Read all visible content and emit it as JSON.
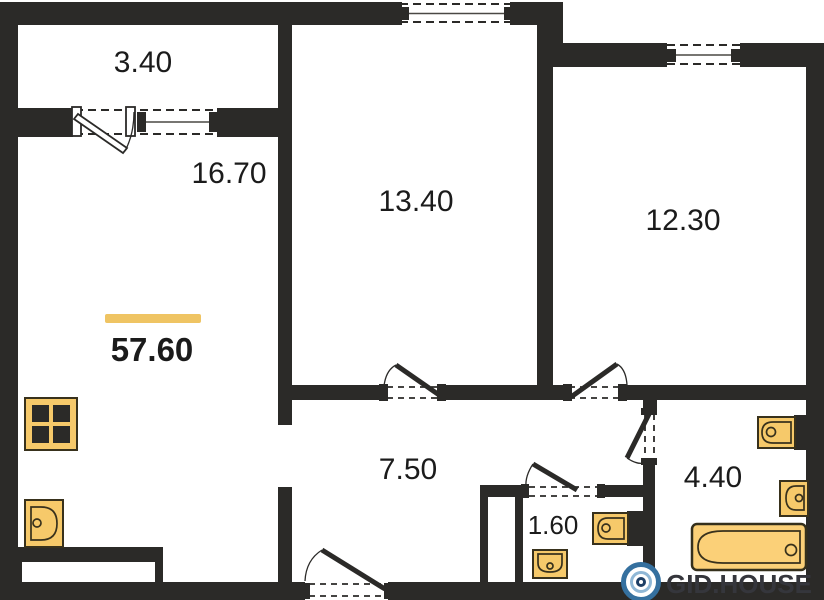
{
  "areas": {
    "balcony": "3.40",
    "living_kitchen": "16.70",
    "bedroom_1": "13.40",
    "bedroom_2": "12.30",
    "hallway": "7.50",
    "wc": "1.60",
    "bathroom": "4.40",
    "total": "57.60"
  },
  "watermark": {
    "brand": "GID.HOUSE"
  },
  "fixtures": {
    "stove": "stove-icon",
    "kitchen_sink": "kitchen-sink-icon",
    "wc_toilet": "toilet-icon",
    "wc_sink": "washbasin-icon",
    "bathroom_toilet": "toilet-icon",
    "bathroom_sink": "washbasin-icon",
    "bathtub": "bathtub-icon"
  },
  "colors": {
    "wall": "#2b2a28",
    "fixture_fill": "#f6c96a",
    "fixture_stroke": "#38311c",
    "accent_bar": "#efc463",
    "logo_ring_blue": "#35709f",
    "logo_center_navy": "#1e3f66",
    "label_text": "#1b1b1b",
    "watermark_text": "#35363c"
  }
}
